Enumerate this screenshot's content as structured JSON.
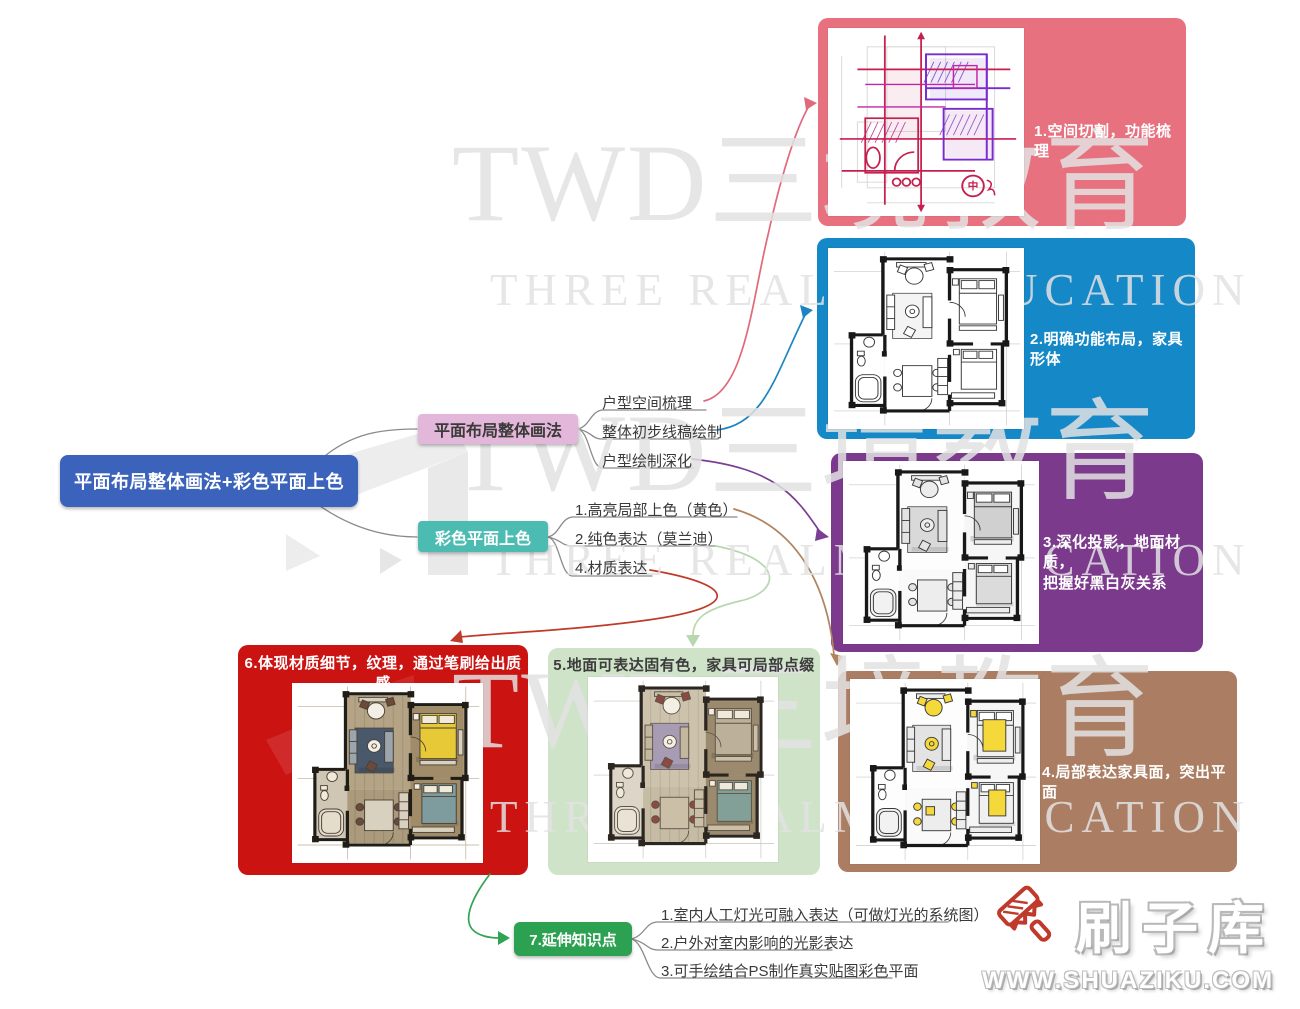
{
  "root": {
    "label": "平面布局整体画法+彩色平面上色",
    "bg": "#3c63bb"
  },
  "branches": {
    "layout": {
      "label": "平面布局整体画法",
      "bg": "#e3b7da",
      "children": [
        "户型空间梳理",
        "整体初步线稿绘制",
        "户型绘制深化"
      ]
    },
    "color": {
      "label": "彩色平面上色",
      "bg": "#4cbcb2",
      "children": [
        "1.高亮局部上色（黄色）",
        "2.纯色表达（莫兰迪）",
        "4.材质表达"
      ]
    }
  },
  "panels": [
    {
      "caption": "1.空间切割，功能梳理",
      "color": "#e8717f",
      "text": "#ffffff"
    },
    {
      "caption": "2.明确功能布局，家具形体",
      "color": "#1588c8",
      "text": "#ffffff"
    },
    {
      "caption": "3.深化投影，地面材质，\n把握好黑白灰关系",
      "color": "#7b3a8c",
      "text": "#ffffff"
    },
    {
      "caption": "4.局部表达家具面，突出平面",
      "color": "#ab7d63",
      "text": "#ffffff"
    },
    {
      "caption": "5.地面可表达固有色，家具可局部点缀",
      "color": "#cfe3c8",
      "text": "#3c3c3c"
    },
    {
      "caption": "6.体现材质细节，纹理，通过笔刷给出质感",
      "color": "#cb1312",
      "text": "#ffffff"
    }
  ],
  "extension": {
    "label": "7.延伸知识点",
    "bg": "#2da152",
    "items": [
      "1.室内人工灯光可融入表达（可做灯光的系统图）",
      "2.户外对室内影响的光影表达",
      "3.可手绘结合PS制作真实贴图彩色平面"
    ]
  },
  "arrows": {
    "branch": "#8a8a8a",
    "panel1": "#e0697a",
    "panel2": "#1d84c4",
    "panel3": "#7b3e92",
    "panel4": "#b1835e",
    "panel5": "#b9d7ae",
    "panel6": "#bf3a28",
    "extension": "#2fa452"
  },
  "watermark": {
    "line1": "TWD三境教育",
    "line2": "THREE REALMS EDUCATION"
  },
  "site": {
    "name": "刷子库",
    "url": "WWW.SHUAZIKU.COM"
  }
}
